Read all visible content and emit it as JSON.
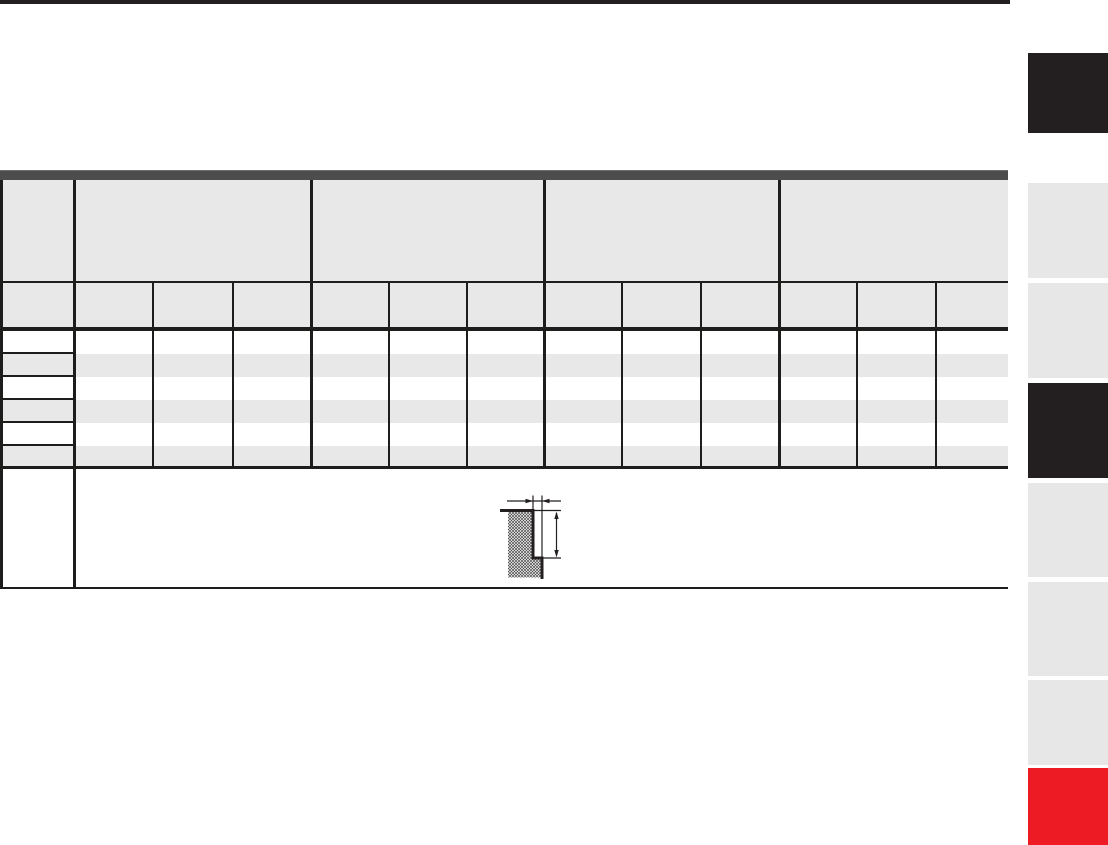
{
  "page": {
    "kind": "catalog-table-page",
    "background": "#ffffff",
    "top_bar_color": "#231f20"
  },
  "table": {
    "strip_color": "#4d4d4d",
    "header_bg": "#e8e8e8",
    "zebra_bg": "#e8e8e8",
    "border_color": "#1d1d1b",
    "corner_label": "",
    "sub_header_first": "",
    "groups": [
      {
        "label": "",
        "sub": [
          "",
          "",
          ""
        ]
      },
      {
        "label": "",
        "sub": [
          "",
          "",
          ""
        ]
      },
      {
        "label": "",
        "sub": [
          "",
          "",
          ""
        ]
      },
      {
        "label": "",
        "sub": [
          "",
          "",
          ""
        ]
      }
    ],
    "rows": [
      {
        "label": "",
        "values": [
          "",
          "",
          "",
          "",
          "",
          "",
          "",
          "",
          "",
          "",
          "",
          ""
        ]
      },
      {
        "label": "",
        "values": [
          "",
          "",
          "",
          "",
          "",
          "",
          "",
          "",
          "",
          "",
          "",
          ""
        ]
      },
      {
        "label": "",
        "values": [
          "",
          "",
          "",
          "",
          "",
          "",
          "",
          "",
          "",
          "",
          "",
          ""
        ]
      },
      {
        "label": "",
        "values": [
          "",
          "",
          "",
          "",
          "",
          "",
          "",
          "",
          "",
          "",
          "",
          ""
        ]
      },
      {
        "label": "",
        "values": [
          "",
          "",
          "",
          "",
          "",
          "",
          "",
          "",
          "",
          "",
          "",
          ""
        ]
      },
      {
        "label": "",
        "values": [
          "",
          "",
          "",
          "",
          "",
          "",
          "",
          "",
          "",
          "",
          "",
          ""
        ]
      }
    ],
    "bottom_row_label": ""
  },
  "diagram": {
    "name": "groove-cross-section",
    "line_color": "#231f20",
    "features": [
      "hatched-material-section",
      "groove-width-dimension-arrows",
      "groove-depth-dimension-arrows"
    ]
  },
  "edge_tabs": {
    "colors": {
      "black": "#231f20",
      "gray": "#e7e7e7",
      "red": "#ed1c24"
    },
    "items": [
      {
        "id": "tab-1",
        "style": "black"
      },
      {
        "id": "tab-2",
        "style": "gray"
      },
      {
        "id": "tab-3",
        "style": "gray"
      },
      {
        "id": "tab-4",
        "style": "black"
      },
      {
        "id": "tab-5",
        "style": "gray"
      },
      {
        "id": "tab-6",
        "style": "gray"
      },
      {
        "id": "tab-7",
        "style": "gray"
      },
      {
        "id": "tab-8",
        "style": "red"
      }
    ]
  }
}
